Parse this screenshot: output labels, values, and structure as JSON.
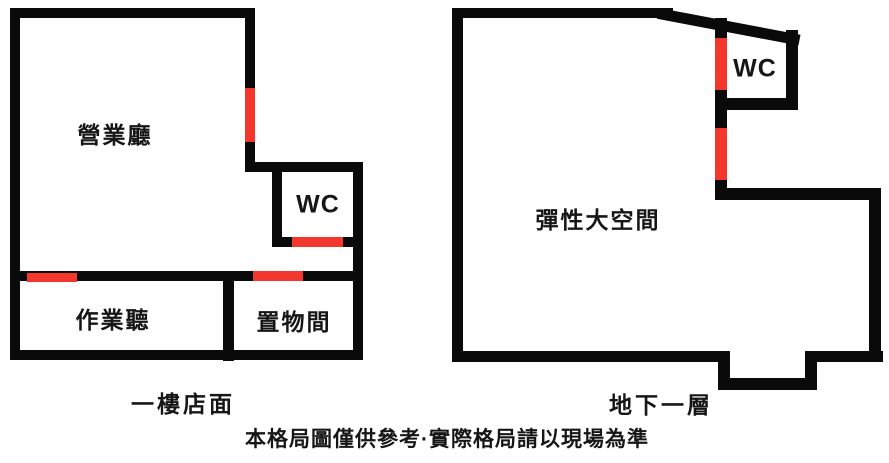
{
  "colors": {
    "wall": "#0a0a0a",
    "door": "#f3372d",
    "text": "#161616",
    "background": "#ffffff"
  },
  "plans": [
    {
      "name": "first-floor",
      "caption": "一樓店面",
      "rooms": [
        {
          "label": "營業廳"
        },
        {
          "label": "WC"
        },
        {
          "label": "作業聽"
        },
        {
          "label": "置物間"
        }
      ]
    },
    {
      "name": "basement",
      "caption": "地下一層",
      "rooms": [
        {
          "label": "WC"
        },
        {
          "label": "彈性大空間"
        }
      ]
    }
  ],
  "disclaimer": "本格局圖僅供參考·實際格局請以現場為準"
}
